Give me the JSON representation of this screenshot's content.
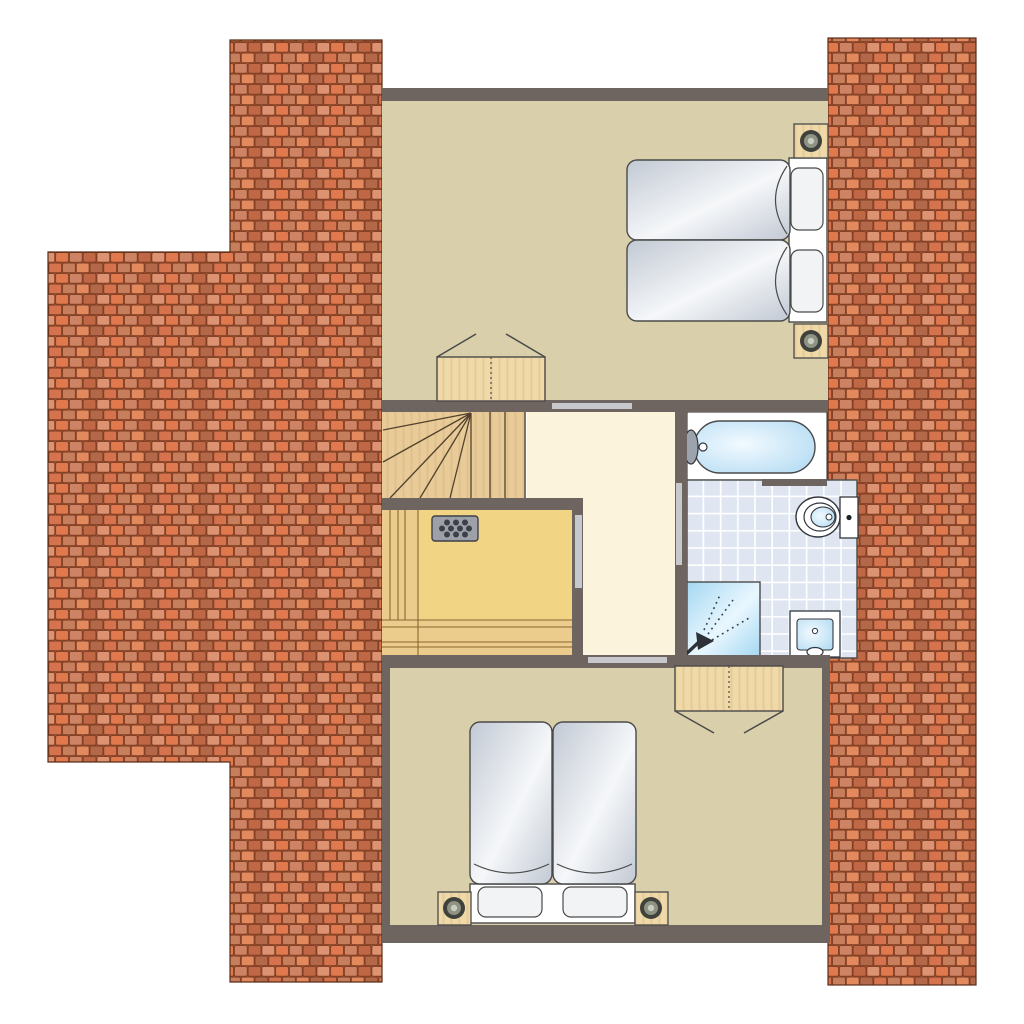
{
  "title": "attic floor plan",
  "canvas": {
    "width": 1024,
    "height": 1024
  },
  "palette": {
    "wall": "#6E6560",
    "floor": "#D9D0AB",
    "hall_floor": "#FBF3DC",
    "stair_wood": "#E8CB98",
    "sauna_floor": "#F1D584",
    "bench_wood": "#EBCC8D",
    "wood_block": "#EFD9A8",
    "heater_gray": "#9EA0A8",
    "tile_blue": "#DFE6F2",
    "grout_white": "#FFFFFF",
    "water_light": "#F2FAFF",
    "water_edge": "#AFD9F2",
    "shower_a": "#A5D8F2",
    "shower_b": "#E9F7FF",
    "mattress_edge": "#C2C9D4",
    "mattress_light": "#F5F7F9",
    "door_marker": "#C7C8CC",
    "outline": "#4A4A4A",
    "brick_mortar": "#A05435",
    "brick_line": "#7C3B20",
    "brick_1": "#E0794E",
    "brick_2": "#CE8464",
    "brick_3": "#C06845",
    "brick_4": "#DD9372",
    "brick_5": "#D4734D",
    "brick_6": "#C67E5C",
    "brick_7": "#E28A5E",
    "brick_8": "#B4684A"
  },
  "rooms": [
    {
      "id": "bedroom-top",
      "label": "top bedroom with two single beds"
    },
    {
      "id": "landing",
      "label": "landing hallway"
    },
    {
      "id": "staircase",
      "label": "winder staircase"
    },
    {
      "id": "sauna",
      "label": "sauna with benches and heater"
    },
    {
      "id": "bathroom",
      "label": "bathroom with bathtub, toilet, shower and washbasin"
    },
    {
      "id": "bedroom-bottom",
      "label": "bottom bedroom with two single beds"
    }
  ],
  "furniture": [
    {
      "id": "roof-left",
      "label": "tiled roof surface left"
    },
    {
      "id": "roof-right",
      "label": "tiled roof surface right"
    },
    {
      "id": "twin-beds-top",
      "label": "two single beds with pillows"
    },
    {
      "id": "twin-beds-bottom",
      "label": "two single beds with pillows"
    },
    {
      "id": "bedside-lamp",
      "label": "bedside block with lamp",
      "count": 4
    },
    {
      "id": "wardrobe-top",
      "label": "wardrobe with open doors"
    },
    {
      "id": "wardrobe-bottom",
      "label": "wardrobe with open doors"
    },
    {
      "id": "sauna-heater",
      "label": "sauna stove with stones"
    },
    {
      "id": "bathtub",
      "label": "bathtub with tap"
    },
    {
      "id": "toilet",
      "label": "toilet with cistern"
    },
    {
      "id": "shower",
      "label": "shower corner with hand shower spray"
    },
    {
      "id": "washbasin",
      "label": "washbasin"
    },
    {
      "id": "door-openings",
      "label": "door opening markers",
      "count": 4
    }
  ]
}
